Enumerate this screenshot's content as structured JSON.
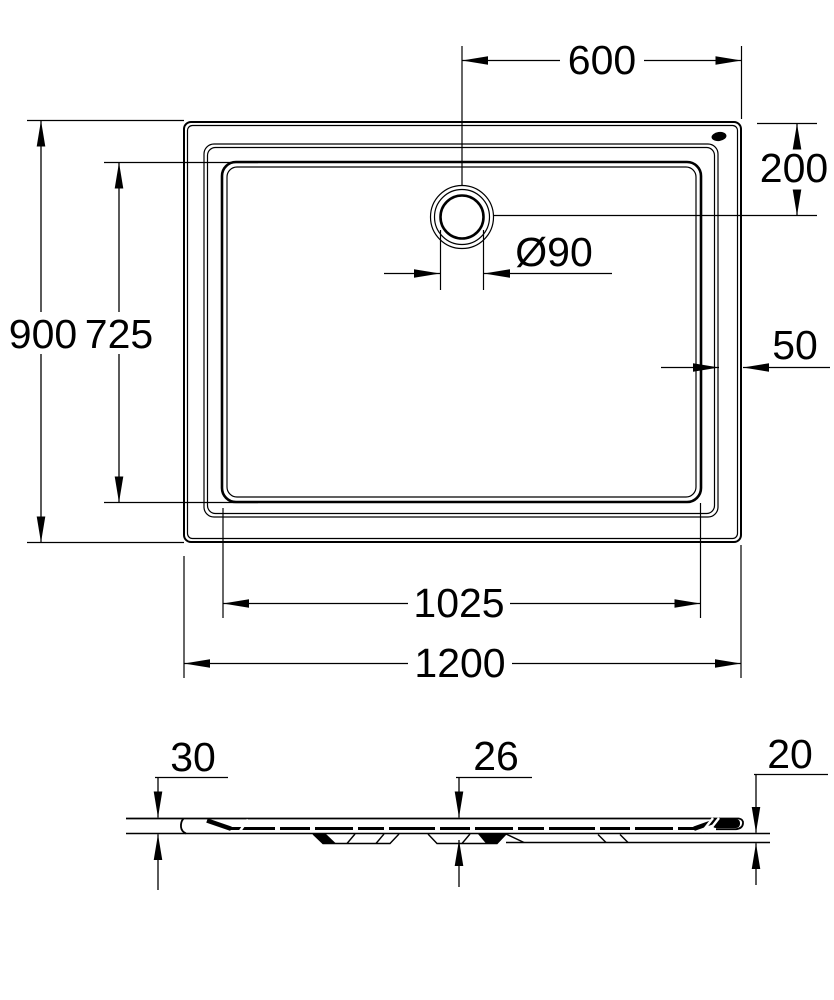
{
  "drawing": {
    "type": "technical dimension drawing",
    "product": "rectangular shower tray, plan view and side section",
    "units": "mm",
    "background_color": "#ffffff",
    "line_color": "#000000",
    "top_view": {
      "outer_width": "1200",
      "outer_depth": "900",
      "inner_width": "1025",
      "inner_depth": "725",
      "drain_offset_from_right": "600",
      "drain_offset_from_top": "200",
      "drain_diameter": "Ø90",
      "rim_width": "50"
    },
    "side_view": {
      "left_edge_height": "30",
      "center_height": "26",
      "right_edge_height": "20"
    }
  }
}
